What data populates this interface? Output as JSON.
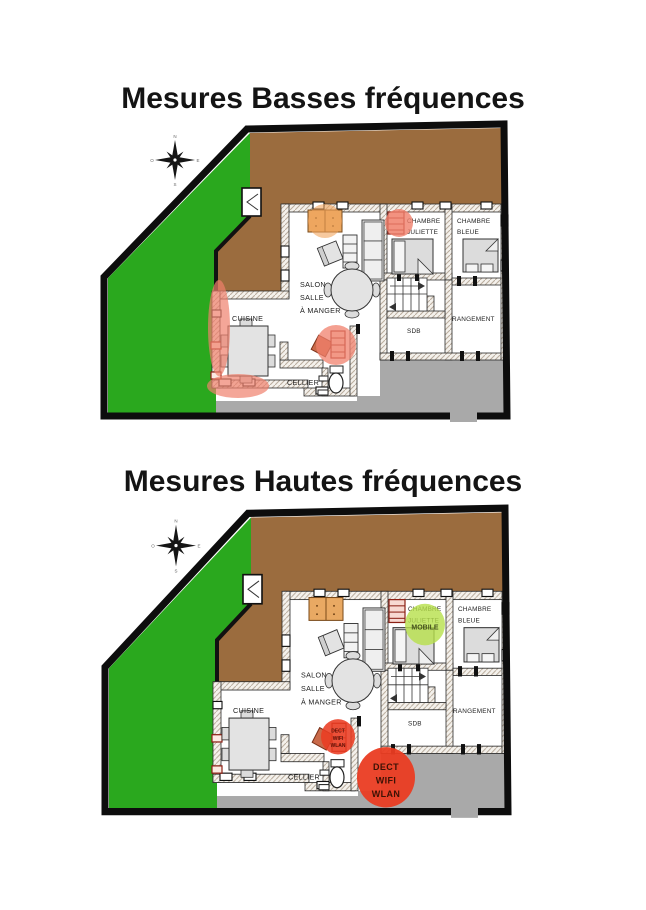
{
  "page": {
    "background": "#ffffff"
  },
  "sections": [
    {
      "id": "basses",
      "title": "Mesures Basses fréquences"
    },
    {
      "id": "hautes",
      "title": "Mesures Hautes fréquences"
    }
  ],
  "compass": {
    "n": "N",
    "e": "E",
    "s": "S",
    "o": "O"
  },
  "rooms": {
    "salon": [
      "SALON",
      "SALLE",
      "À MANGER"
    ],
    "cuisine": "CUISINE",
    "cellier": "CELLIER",
    "chambre_juliette": [
      "CHAMBRE",
      "JULIETTE"
    ],
    "chambre_bleue": [
      "CHAMBRE",
      "BLEUE"
    ],
    "sdb": "SDB",
    "rangement": "RANGEMENT"
  },
  "markers": {
    "mobile": {
      "label": "MOBILE",
      "color": "#b6e04a"
    },
    "dect_small": {
      "lines": [
        "DECT",
        "WIFI",
        "WLAN"
      ],
      "color": "#ea3c22"
    },
    "dect_large": {
      "lines": [
        "DECT",
        "WIFI",
        "WLAN"
      ],
      "color": "#ea3c22"
    }
  },
  "colors": {
    "lawn": "#2aa81e",
    "soil": "#9b6c3e",
    "terrace": "#a9a9a9",
    "hotspot_red": "#f0806c",
    "hotspot_orange": "#f2a55e"
  }
}
